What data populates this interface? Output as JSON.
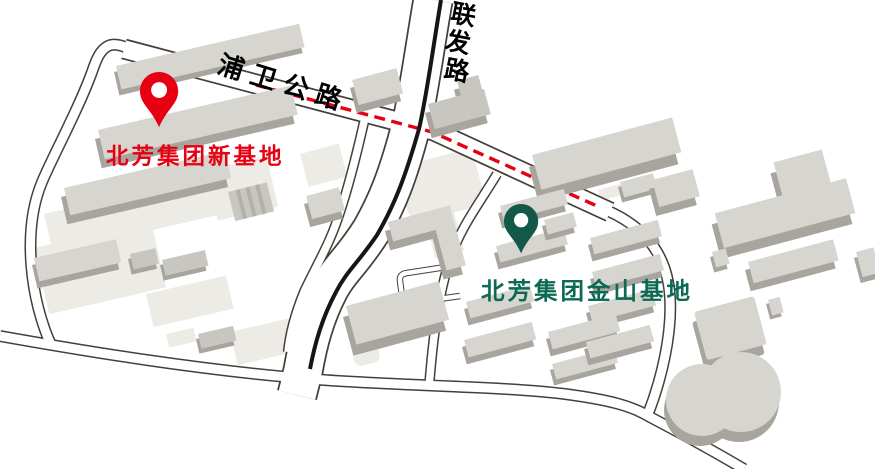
{
  "roads": {
    "puwei": {
      "name": "浦卫公路"
    },
    "lianfa": {
      "name": "联发路",
      "chars": [
        "联",
        "发",
        "路"
      ]
    }
  },
  "locations": {
    "new_base": {
      "label": "北芳集团新基地",
      "pin_color": "#e60012",
      "label_color": "#e60012"
    },
    "jinshan_base": {
      "label": "北芳集团金山基地",
      "pin_color": "#14584a",
      "label_color": "#0c6a54"
    }
  },
  "colors": {
    "background": "#ffffff",
    "road_casing": "#453f38",
    "road_fill": "#ffffff",
    "route_dash": "#e60012",
    "road_center_line": "#161616",
    "building_top": "#d7d5d0",
    "building_side": "#a8a59f",
    "building_top_dark": "#c8c6c0",
    "parcel": "#ecebe5",
    "road_label": "#000000"
  }
}
